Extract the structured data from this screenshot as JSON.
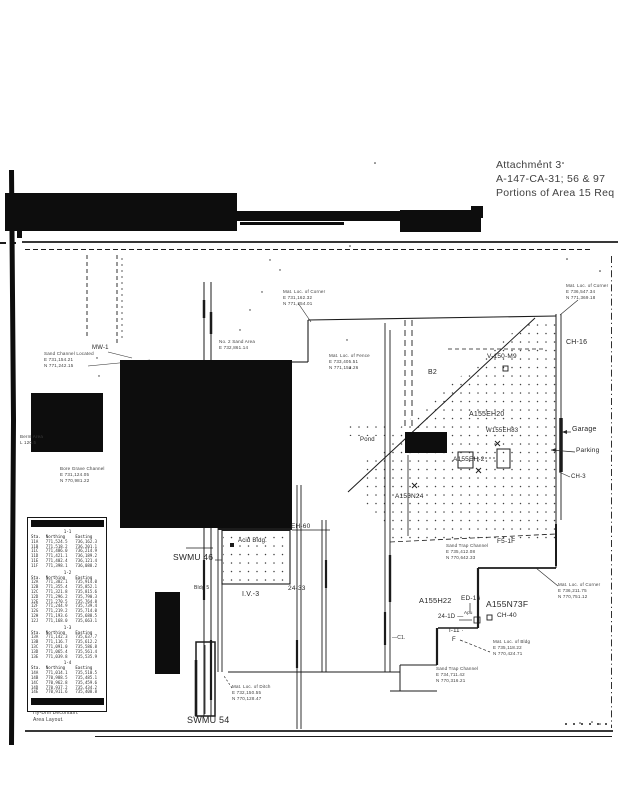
{
  "document": {
    "attachment_line1": "Attachment 3",
    "attachment_line2": "A-147-CA-31; 56 & 97",
    "attachment_line3": "Portions of Area 15 Req"
  },
  "colors": {
    "ink": "#1b1b1b",
    "paper": "#ffffff",
    "redaction": "#0d0d0d"
  },
  "labels": {
    "mw1": "MW-1",
    "swmu46": "SWMU 46",
    "swmu54": "SWMU 54",
    "acid_bldg": "Acid Bldg.",
    "lv3": "I.V.-3",
    "bldg5": "Bldg 5",
    "eh60": "EH-60",
    "loc2433": "24-33",
    "ch16": "CH-16",
    "v150m9": "V-150-M9",
    "b2": "B2",
    "a155eh20": "A155EH20",
    "w155eh83": "W155EH83",
    "a155eh2": "A155EH-2",
    "a155n24": "A155N24",
    "pond": "Pond",
    "garage": "Garage",
    "parking": "Parking",
    "ch3": "CH-3",
    "f51f": "F5-1F",
    "a155h22": "A155H22",
    "ed16": "ED-16",
    "a155n73f": "A155N73F",
    "ch40": "CH-40",
    "loc241d": "24-1D —",
    "apu": "Apu",
    "i11": "I-11 ·",
    "f": "F",
    "c1": "—C1."
  },
  "notes": {
    "nw": [
      "Mat. Loc. of Corner",
      "E 731,162.32",
      "N 771,254.01"
    ],
    "mid": [
      "Mat. Loc. of Fence",
      "E 733,405.51",
      "N 771,153.26"
    ],
    "mid2": [
      "No. 2 Sand Area",
      "E 732,861.14"
    ],
    "ne": [
      "Mat. Loc. of Corner",
      "E 736,547.34",
      "N 771,369.18"
    ],
    "sand": [
      "Sand Channel Located",
      "E 731,154.21",
      "N 771,242.15"
    ],
    "below_box": [
      "Berm Area",
      "L 120.5"
    ],
    "bore": [
      "Bore Grave Channel",
      "E 731,124.05",
      "N 770,981.22"
    ],
    "bc": [
      "Sand Trap Channel",
      "E 735,412.08",
      "N 770,642.33"
    ],
    "right": [
      "Mat. Loc. of Corner",
      "E 736,211.75",
      "N 770,751.12"
    ],
    "br1": [
      "Mat. Loc. of Bldg",
      "E 735,118.22",
      "N 770,424.71"
    ],
    "br2": [
      "Sand Trap Channel",
      "E 734,711.42",
      "N 770,316.21"
    ],
    "b54": [
      "Mat. Loc. of Ditch",
      "E 732,150.55",
      "N 770,128.47"
    ],
    "bl": [
      "Hy-Drill Decontam.",
      "Area Layout."
    ]
  },
  "table": {
    "sections": [
      {
        "title": "1-1",
        "headers": [
          "Sta.",
          "Northing",
          "Easting"
        ],
        "rows": [
          [
            "11A",
            "771,524.5",
            "736,162.3"
          ],
          [
            "11B",
            "771,518.2",
            "736,201.1"
          ],
          [
            "11C",
            "771,486.0",
            "736,214.9"
          ],
          [
            "11D",
            "771,421.1",
            "736,189.2"
          ],
          [
            "11E",
            "771,402.4",
            "736,121.4"
          ],
          [
            "11F",
            "771,398.1",
            "736,088.2"
          ]
        ]
      },
      {
        "title": "1-2",
        "headers": [
          "Sta.",
          "Northing",
          "Easting"
        ],
        "rows": [
          [
            "12A",
            "771,382.1",
            "735,914.0"
          ],
          [
            "12B",
            "771,355.4",
            "735,852.1"
          ],
          [
            "12C",
            "771,321.8",
            "735,815.6"
          ],
          [
            "12D",
            "771,296.2",
            "735,790.3"
          ],
          [
            "12E",
            "771,270.5",
            "735,764.8"
          ],
          [
            "12F",
            "771,244.9",
            "735,739.4"
          ],
          [
            "12G",
            "771,219.2",
            "735,714.0"
          ],
          [
            "12H",
            "771,193.6",
            "735,688.5"
          ],
          [
            "12J",
            "771,168.0",
            "735,663.1"
          ]
        ]
      },
      {
        "title": "1-3",
        "headers": [
          "Sta.",
          "Northing",
          "Easting"
        ],
        "rows": [
          [
            "13A",
            "771,142.3",
            "735,637.7"
          ],
          [
            "13B",
            "771,116.7",
            "735,612.2"
          ],
          [
            "13C",
            "771,091.0",
            "735,586.8"
          ],
          [
            "13D",
            "771,065.4",
            "735,561.4"
          ],
          [
            "13E",
            "771,039.8",
            "735,535.9"
          ]
        ]
      },
      {
        "title": "1-4",
        "headers": [
          "Sta.",
          "Northing",
          "Easting"
        ],
        "rows": [
          [
            "14A",
            "771,014.1",
            "735,510.5"
          ],
          [
            "14B",
            "770,988.5",
            "735,485.1"
          ],
          [
            "14C",
            "770,962.8",
            "735,459.6"
          ],
          [
            "14D",
            "770,937.2",
            "735,434.2"
          ],
          [
            "14E",
            "770,911.6",
            "735,408.8"
          ]
        ]
      }
    ]
  }
}
